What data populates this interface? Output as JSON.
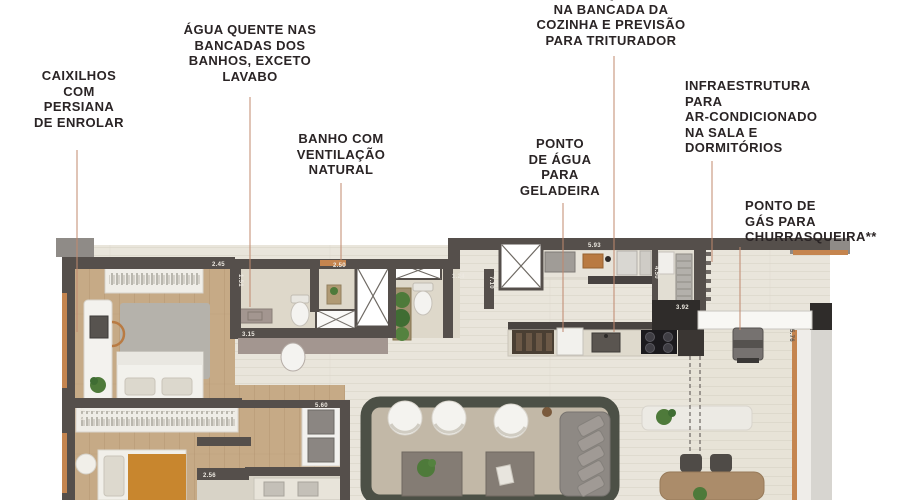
{
  "page": {
    "width": 900,
    "height": 500,
    "background": "#ffffff",
    "type": "floor-plan-marketing-image"
  },
  "colors": {
    "label_text": "#2a2425",
    "leader_line": "#c0886e",
    "wall_dark": "#554f4b",
    "wall_black_block": "#2f2c2a",
    "corner_gray": "#8f8b87",
    "wood_floor": "#c6aa86",
    "tile_floor": "#e9e5db",
    "bath_floor": "#ded8ca",
    "terrace_floor": "#e7e3d7",
    "accent_wood_window": "#c5854f",
    "counter_mauve": "#a39690",
    "rug_bedroom": "#b5b2ab",
    "rug_living_center": "#c2b8a7",
    "rug_living_border": "#4c5046",
    "furniture_white": "#f2f1ec",
    "furniture_gray": "#8e8984",
    "plant_green": "#4e7a3a",
    "parapet_white": "#f8f7f4",
    "cooktop_black": "#1b1a1d"
  },
  "annotations": [
    {
      "id": "caixilhos",
      "text": "CAIXILHOS\nCOM\nPERSIANA\nDE ENROLAR",
      "x": 79,
      "y": 68,
      "align": "center",
      "leader": {
        "x": 77,
        "y1": 150,
        "y2": 332
      }
    },
    {
      "id": "agua-quente-banhos",
      "text": "ÁGUA QUENTE NAS\nBANCADAS DOS\nBANHOS, EXCETO\nLAVABO",
      "x": 250,
      "y": 22,
      "align": "center",
      "leader": {
        "x": 250,
        "y1": 97,
        "y2": 307
      }
    },
    {
      "id": "banho-ventilacao",
      "text": "BANHO COM\nVENTILAÇÃO\nNATURAL",
      "x": 341,
      "y": 131,
      "align": "center",
      "leader": {
        "x": 341,
        "y1": 183,
        "y2": 260
      }
    },
    {
      "id": "agua-quente-cozinha",
      "text": "ÁGUA QUENTE\nNA BANCADA DA\nCOZINHA E PREVISÃO\nPARA TRITURADOR",
      "x": 611,
      "y": -14,
      "align": "center",
      "leader": {
        "x": 614,
        "y1": 56,
        "y2": 332
      }
    },
    {
      "id": "ponto-agua-geladeira",
      "text": "PONTO\nDE ÁGUA\nPARA\nGELADEIRA",
      "x": 560,
      "y": 136,
      "align": "center",
      "leader": {
        "x": 563,
        "y1": 203,
        "y2": 332
      }
    },
    {
      "id": "infraestrutura-ar",
      "text": "INFRAESTRUTURA\nPARA\nAR-CONDICIONADO\nNA SALA E\nDORMITÓRIOS",
      "x": 685,
      "y": 78,
      "align": "left",
      "leader": {
        "x": 712,
        "y1": 161,
        "y2": 262
      }
    },
    {
      "id": "ponto-gas-churrasqueira",
      "text": "PONTO DE\nGÁS PARA\nCHURRASQUEIRA**",
      "x": 745,
      "y": 198,
      "align": "left",
      "leader": {
        "x": 740,
        "y1": 247,
        "y2": 330
      }
    }
  ],
  "dimensions": [
    {
      "t": "2.45",
      "x": 212,
      "y": 266,
      "rot": 0,
      "dark": false
    },
    {
      "t": "1.51",
      "x": 239,
      "y": 274,
      "rot": 90,
      "dark": false
    },
    {
      "t": "2.50",
      "x": 333,
      "y": 267,
      "rot": 0,
      "dark": false
    },
    {
      "t": "1.24",
      "x": 452,
      "y": 278,
      "rot": 0,
      "dark": false
    },
    {
      "t": "7.10",
      "x": 490,
      "y": 276,
      "rot": 90,
      "dark": false
    },
    {
      "t": "5.93",
      "x": 588,
      "y": 247,
      "rot": 0,
      "dark": false
    },
    {
      "t": "3.15",
      "x": 242,
      "y": 336,
      "rot": 0,
      "dark": false
    },
    {
      "t": "4.50",
      "x": 655,
      "y": 266,
      "rot": 90,
      "dark": false
    },
    {
      "t": "3.92",
      "x": 676,
      "y": 309,
      "rot": 0,
      "dark": false
    },
    {
      "t": "5.76",
      "x": 790,
      "y": 329,
      "rot": 90,
      "dark": true
    },
    {
      "t": "4.04",
      "x": 80,
      "y": 408,
      "rot": 90,
      "dark": false
    },
    {
      "t": "5.60",
      "x": 315,
      "y": 407,
      "rot": 0,
      "dark": false
    },
    {
      "t": "2.56",
      "x": 203,
      "y": 477,
      "rot": 0,
      "dark": false
    }
  ]
}
